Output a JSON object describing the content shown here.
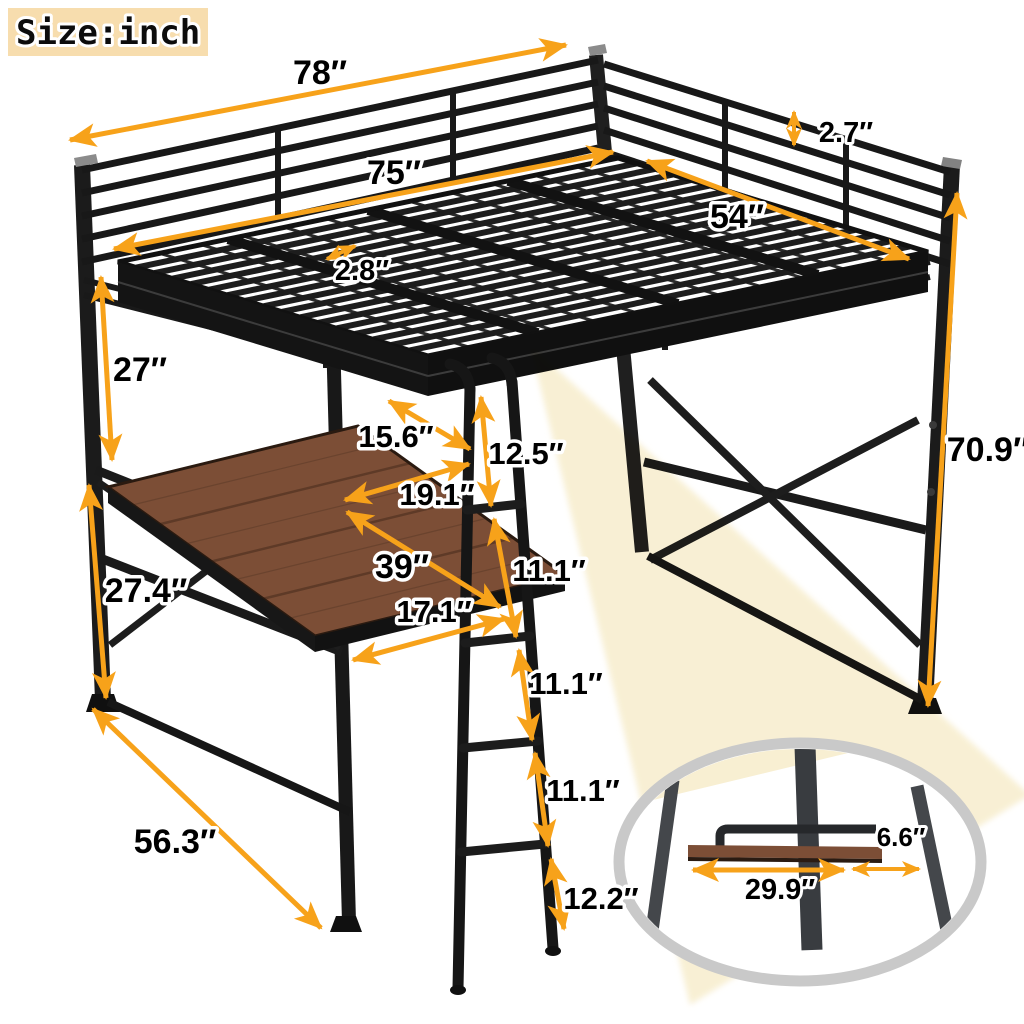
{
  "badge": {
    "label": "Size:inch"
  },
  "colors": {
    "arrow": "#F7A21A",
    "metal": "#1b1b1b",
    "wood": "#7C4E36",
    "beam": "#F8EFD2",
    "badge_bg": "#F7DDAE",
    "ring": "#C9C9C9"
  },
  "dims": {
    "top_length": "78″",
    "inner_length": "75″",
    "bed_width": "54″",
    "rail_gap": "2.7″",
    "slat_gap": "2.8″",
    "under_bed_clearance": "27″",
    "desk_height": "27.4″",
    "overall_height": "70.9″",
    "desk_side_depth": "15.6″",
    "desk_mid_depth": "19.1″",
    "desk_length": "39″",
    "desk_front_width": "17.1″",
    "ladder_top_segment": "12.5″",
    "ladder_segment_2": "11.1″",
    "ladder_segment_3": "11.1″",
    "ladder_segment_4": "11.1″",
    "ladder_bottom_segment": "12.2″",
    "base_diagonal": "56.3″",
    "shelf_length": "29.9″",
    "shelf_depth": "6.6″"
  }
}
